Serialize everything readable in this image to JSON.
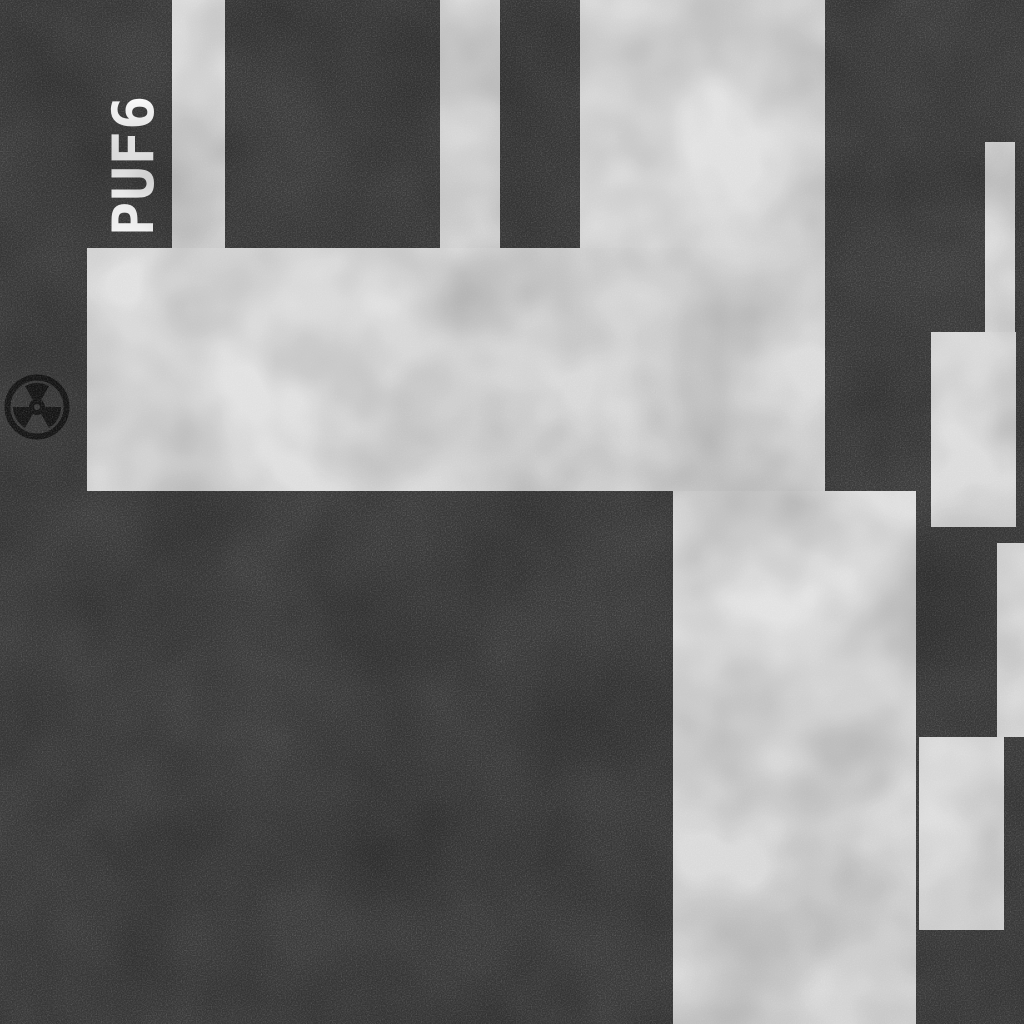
{
  "scene": {
    "type": "top-down-map",
    "label": "PUF6",
    "colors": {
      "background": "#3b3b3b",
      "floor": "#dedede",
      "label": "#ffffff",
      "icon": "#141414"
    },
    "marker": {
      "icon": "radiation-icon",
      "x": 37,
      "y": 407,
      "size": 66
    },
    "rooms": [
      {
        "x": 172,
        "y": 0,
        "w": 53,
        "h": 300
      },
      {
        "x": 440,
        "y": 0,
        "w": 60,
        "h": 300
      },
      {
        "x": 580,
        "y": 0,
        "w": 245,
        "h": 491
      },
      {
        "x": 87,
        "y": 248,
        "w": 738,
        "h": 243
      },
      {
        "x": 673,
        "y": 491,
        "w": 243,
        "h": 533
      },
      {
        "x": 985,
        "y": 142,
        "w": 30,
        "h": 200
      },
      {
        "x": 931,
        "y": 332,
        "w": 85,
        "h": 195
      },
      {
        "x": 997,
        "y": 543,
        "w": 27,
        "h": 194
      },
      {
        "x": 919,
        "y": 737,
        "w": 85,
        "h": 193
      }
    ]
  }
}
